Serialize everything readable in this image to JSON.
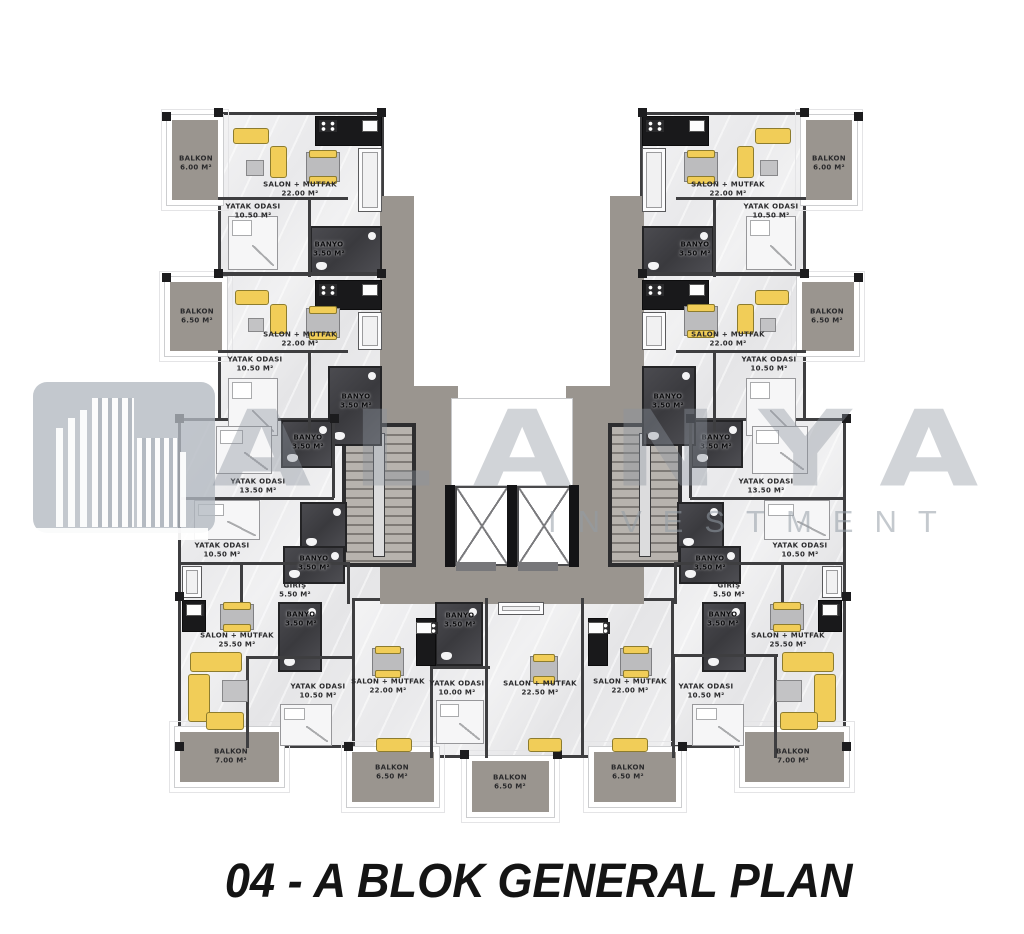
{
  "title": {
    "text": "04 - A BLOK GENERAL PLAN"
  },
  "watermark": {
    "brand": "ALANYA",
    "sub": "INVESTMENT",
    "logo": "alanya-buildings-logo"
  },
  "colors": {
    "furniture_accent": "#f1cd58",
    "wall": "#3e3e40",
    "balcony_marble": "#9a958f",
    "floor": "#efeff0",
    "dark_room": "#47474b",
    "watermark_gray": "#8b939d"
  },
  "plan": {
    "block": "A",
    "labels": [
      {
        "id": "balkon-top-left",
        "text": "BALKON\n6.00 M²"
      },
      {
        "id": "salon-top-left",
        "text": "SALON + MUTFAK\n22.00 M²"
      },
      {
        "id": "yatak-top-left",
        "text": "YATAK ODASI\n10.50 M²"
      },
      {
        "id": "banyo-top-left",
        "text": "BANYO\n3.50 M²"
      },
      {
        "id": "balkon-left-2",
        "text": "BALKON\n6.50 M²"
      },
      {
        "id": "salon-left-2",
        "text": "SALON + MUTFAK\n22.00 M²"
      },
      {
        "id": "yatak-left-2",
        "text": "YATAK ODASI\n10.50 M²"
      },
      {
        "id": "banyo-left-2",
        "text": "BANYO\n3.50 M²"
      },
      {
        "id": "banyo-core-left-top",
        "text": "BANYO\n3.50 M²"
      },
      {
        "id": "yatak-core-left-13",
        "text": "YATAK ODASI\n13.50 M²"
      },
      {
        "id": "yatak-core-left-10",
        "text": "YATAK ODASI\n10.50 M²"
      },
      {
        "id": "banyo-core-left-mid",
        "text": "BANYO\n3.50 M²"
      },
      {
        "id": "giris-left",
        "text": "GİRİŞ\n5.50 M²"
      },
      {
        "id": "banyo-bottom-left",
        "text": "BANYO\n3.50 M²"
      },
      {
        "id": "salon-bottom-left",
        "text": "SALON + MUTFAK\n25.50 M²"
      },
      {
        "id": "yatak-bottom-left",
        "text": "YATAK ODASI\n10.50 M²"
      },
      {
        "id": "balkon-bottom-left",
        "text": "BALKON\n7.00 M²"
      },
      {
        "id": "salon-bottom-left2",
        "text": "SALON + MUTFAK\n22.00 M²"
      },
      {
        "id": "banyo-bottom-left2",
        "text": "BANYO\n3.50 M²"
      },
      {
        "id": "yatak-bottom-left2",
        "text": "YATAK ODASI\n10.00 M²"
      },
      {
        "id": "balkon-bottom-left2",
        "text": "BALKON\n6.50 M²"
      },
      {
        "id": "salon-bottom-center",
        "text": "SALON + MUTFAK\n22.50 M²"
      },
      {
        "id": "balkon-bottom-center",
        "text": "BALKON\n6.50 M²"
      },
      {
        "id": "salon-bottom-right2",
        "text": "SALON + MUTFAK\n22.00 M²"
      },
      {
        "id": "balkon-bottom-right2",
        "text": "BALKON\n6.50 M²"
      },
      {
        "id": "salon-bottom-right",
        "text": "SALON + MUTFAK\n25.50 M²"
      },
      {
        "id": "yatak-bottom-right",
        "text": "YATAK ODASI\n10.50 M²"
      },
      {
        "id": "banyo-bottom-right",
        "text": "BANYO\n3.50 M²"
      },
      {
        "id": "balkon-bottom-right",
        "text": "BALKON\n7.00 M²"
      },
      {
        "id": "giris-right",
        "text": "GİRİŞ\n5.50 M²"
      },
      {
        "id": "banyo-core-right-mid",
        "text": "BANYO\n3.50 M²"
      },
      {
        "id": "yatak-core-right-10",
        "text": "YATAK ODASI\n10.50 M²"
      },
      {
        "id": "yatak-core-right-13",
        "text": "YATAK ODASI\n13.50 M²"
      },
      {
        "id": "banyo-core-right-top",
        "text": "BANYO\n3.50 M²"
      },
      {
        "id": "banyo-right-2",
        "text": "BANYO\n3.50 M²"
      },
      {
        "id": "yatak-right-2",
        "text": "YATAK ODASI\n10.50 M²"
      },
      {
        "id": "salon-right-2",
        "text": "SALON + MUTFAK\n22.00 M²"
      },
      {
        "id": "balkon-right-2",
        "text": "BALKON\n6.50 M²"
      },
      {
        "id": "banyo-top-right",
        "text": "BANYO\n3.50 M²"
      },
      {
        "id": "yatak-top-right",
        "text": "YATAK ODASI\n10.50 M²"
      },
      {
        "id": "salon-top-right",
        "text": "SALON + MUTFAK\n22.00 M²"
      },
      {
        "id": "balkon-top-right",
        "text": "BALKON\n6.00 M²"
      }
    ]
  }
}
